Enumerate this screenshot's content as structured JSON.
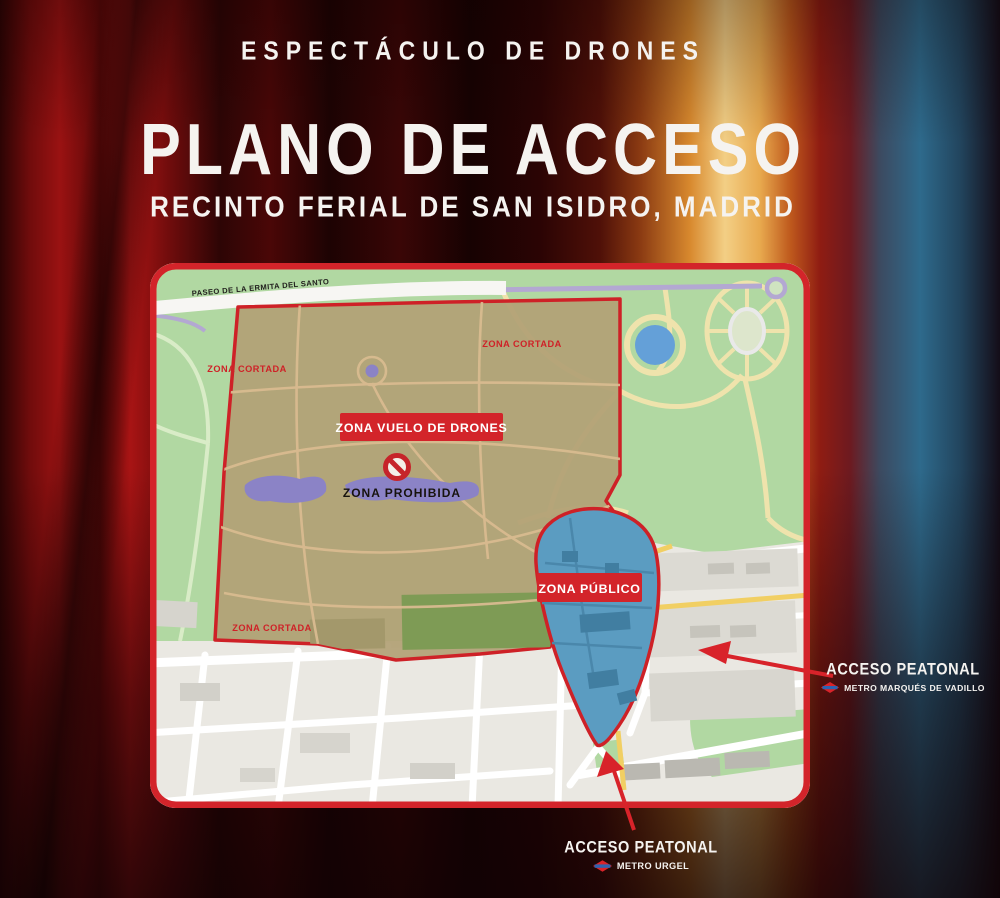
{
  "poster": {
    "kicker": "ESPECTÁCULO DE DRONES",
    "title": "PLANO DE ACCESO",
    "subtitle": "RECINTO FERIAL DE SAN ISIDRO, MADRID"
  },
  "map": {
    "street_label": "PASEO DE LA ERMITA DEL SANTO",
    "zona_cortada_labels": [
      "ZONA CORTADA",
      "ZONA CORTADA",
      "ZONA CORTADA"
    ],
    "drone_zone_badge": "ZONA VUELO DE DRONES",
    "prohibited_label": "ZONA PROHIBIDA",
    "public_zone_badge": "ZONA PÚBLICO"
  },
  "access_points": {
    "right": {
      "title": "ACCESO PEATONAL",
      "station": "METRO MARQUÉS DE VADILLO"
    },
    "bottom": {
      "title": "ACCESO PEATONAL",
      "station": "METRO URGEL"
    }
  },
  "colors": {
    "accent_red": "#d3242a",
    "zone_brown": "#b2a075",
    "zone_blue": "#5b9cc1",
    "park_green": "#b1d8a2",
    "metro_blue": "#2e63b0",
    "title_white": "#f5f3f0"
  }
}
